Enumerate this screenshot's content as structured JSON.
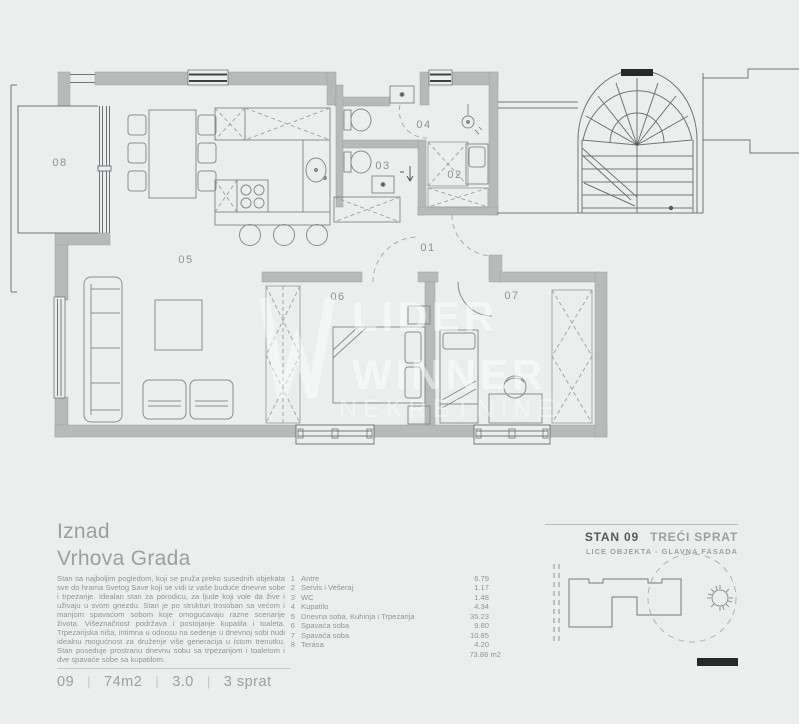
{
  "plan": {
    "room_labels": [
      "01",
      "02",
      "03",
      "04",
      "05",
      "06",
      "07",
      "08"
    ],
    "watermark": [
      "LIDER",
      "WINNER",
      "NEKRETNINE"
    ]
  },
  "info": {
    "title_line1": "Iznad",
    "title_line2": "Vrhova Grada",
    "description": "Stan sa najboljim pogledom, koji se pruža preko susednih objekata sve do hrama Svetog Save koji se vidi iz vaše buduće dnevne sobe i trpezarije. Idealan stan za porodicu, za ljude koji vole da žive i uživaju u svom gnezdu. Stan je po strukturi trosoban sa većom i manjom spavaćom sobom koje omogućavaju razne scenarije života. Višeznačnost podržava i postojanje kupatila i toaleta. Trpezarijska niša, intimna u odnosu na sedenje u dnevnoj sobi nudi idealnu mogućnost za druženje više generacija u istom trenutku. Stan poseduje prostranu dnevnu sobu sa trpezarijom i toaletom i dve spavaće sobe sa kupatilom."
  },
  "legend": {
    "items": [
      {
        "num": "1",
        "name": "Antre",
        "area": "6.79"
      },
      {
        "num": "2",
        "name": "Servis i Vešeraj",
        "area": "1.17"
      },
      {
        "num": "3",
        "name": "WC",
        "area": "1.48"
      },
      {
        "num": "4",
        "name": "Kupatilo",
        "area": "4.34"
      },
      {
        "num": "5",
        "name": "Dnevna soba, Kuhinja i Trpezarija",
        "area": "35.23"
      },
      {
        "num": "6",
        "name": "Spavaća soba",
        "area": "9.80"
      },
      {
        "num": "7",
        "name": "Spavaća soba",
        "area": "10.85"
      },
      {
        "num": "8",
        "name": "Terasa",
        "area": "4.20"
      }
    ],
    "total": "73.86 m2"
  },
  "unit_header": {
    "unit": "STAN 09",
    "floor": "TREĆI SPRAT",
    "subtitle": "LICE OBJEKTA - GLAVNA FASADA"
  },
  "footer": {
    "values": [
      "09",
      "74m2",
      "3.0",
      "3 sprat"
    ],
    "separator": "|"
  },
  "colors": {
    "wall": "#b6bab9",
    "background": "#eceeed",
    "dark_text": "#54595d",
    "muted_text": "#9aa0a3"
  }
}
